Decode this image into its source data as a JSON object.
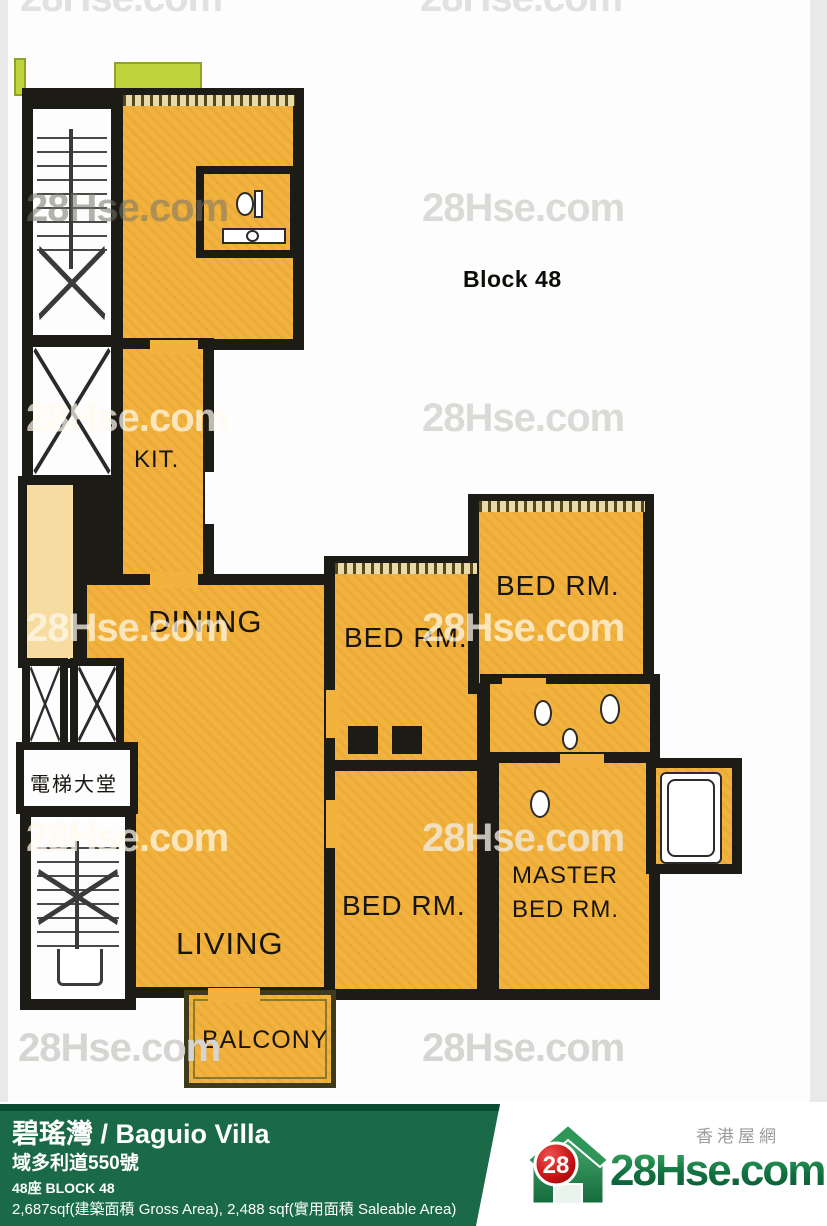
{
  "watermark": {
    "text": "28Hse.com"
  },
  "plan": {
    "block_label": "Block 48",
    "labels": {
      "kitchen": "KIT.",
      "dining": "DINING",
      "living": "LIVING",
      "bed": "BED RM.",
      "master_line1": "MASTER",
      "master_line2": "BED RM.",
      "balcony": "BALCONY",
      "lobby": "電梯大堂"
    },
    "colors": {
      "room_fill": "#F2B23D",
      "pale_fill": "#F6DCA0",
      "wall": "#1D1B16",
      "planter_green": "#BFD43C"
    }
  },
  "footer": {
    "title": "碧瑤灣 / Baguio Villa",
    "address": "域多利道550號",
    "block_line": "48座   BLOCK 48",
    "area_line": "2,687sqf(建築面積 Gross Area), 2,488 sqf(實用面積 Saleable Area)",
    "bar_color": "#1A6A48",
    "logo": {
      "badge": "28",
      "name": "28Hse.com",
      "tagline": "香港屋網",
      "brand_green": "#117040",
      "badge_red": "#C51111"
    }
  }
}
